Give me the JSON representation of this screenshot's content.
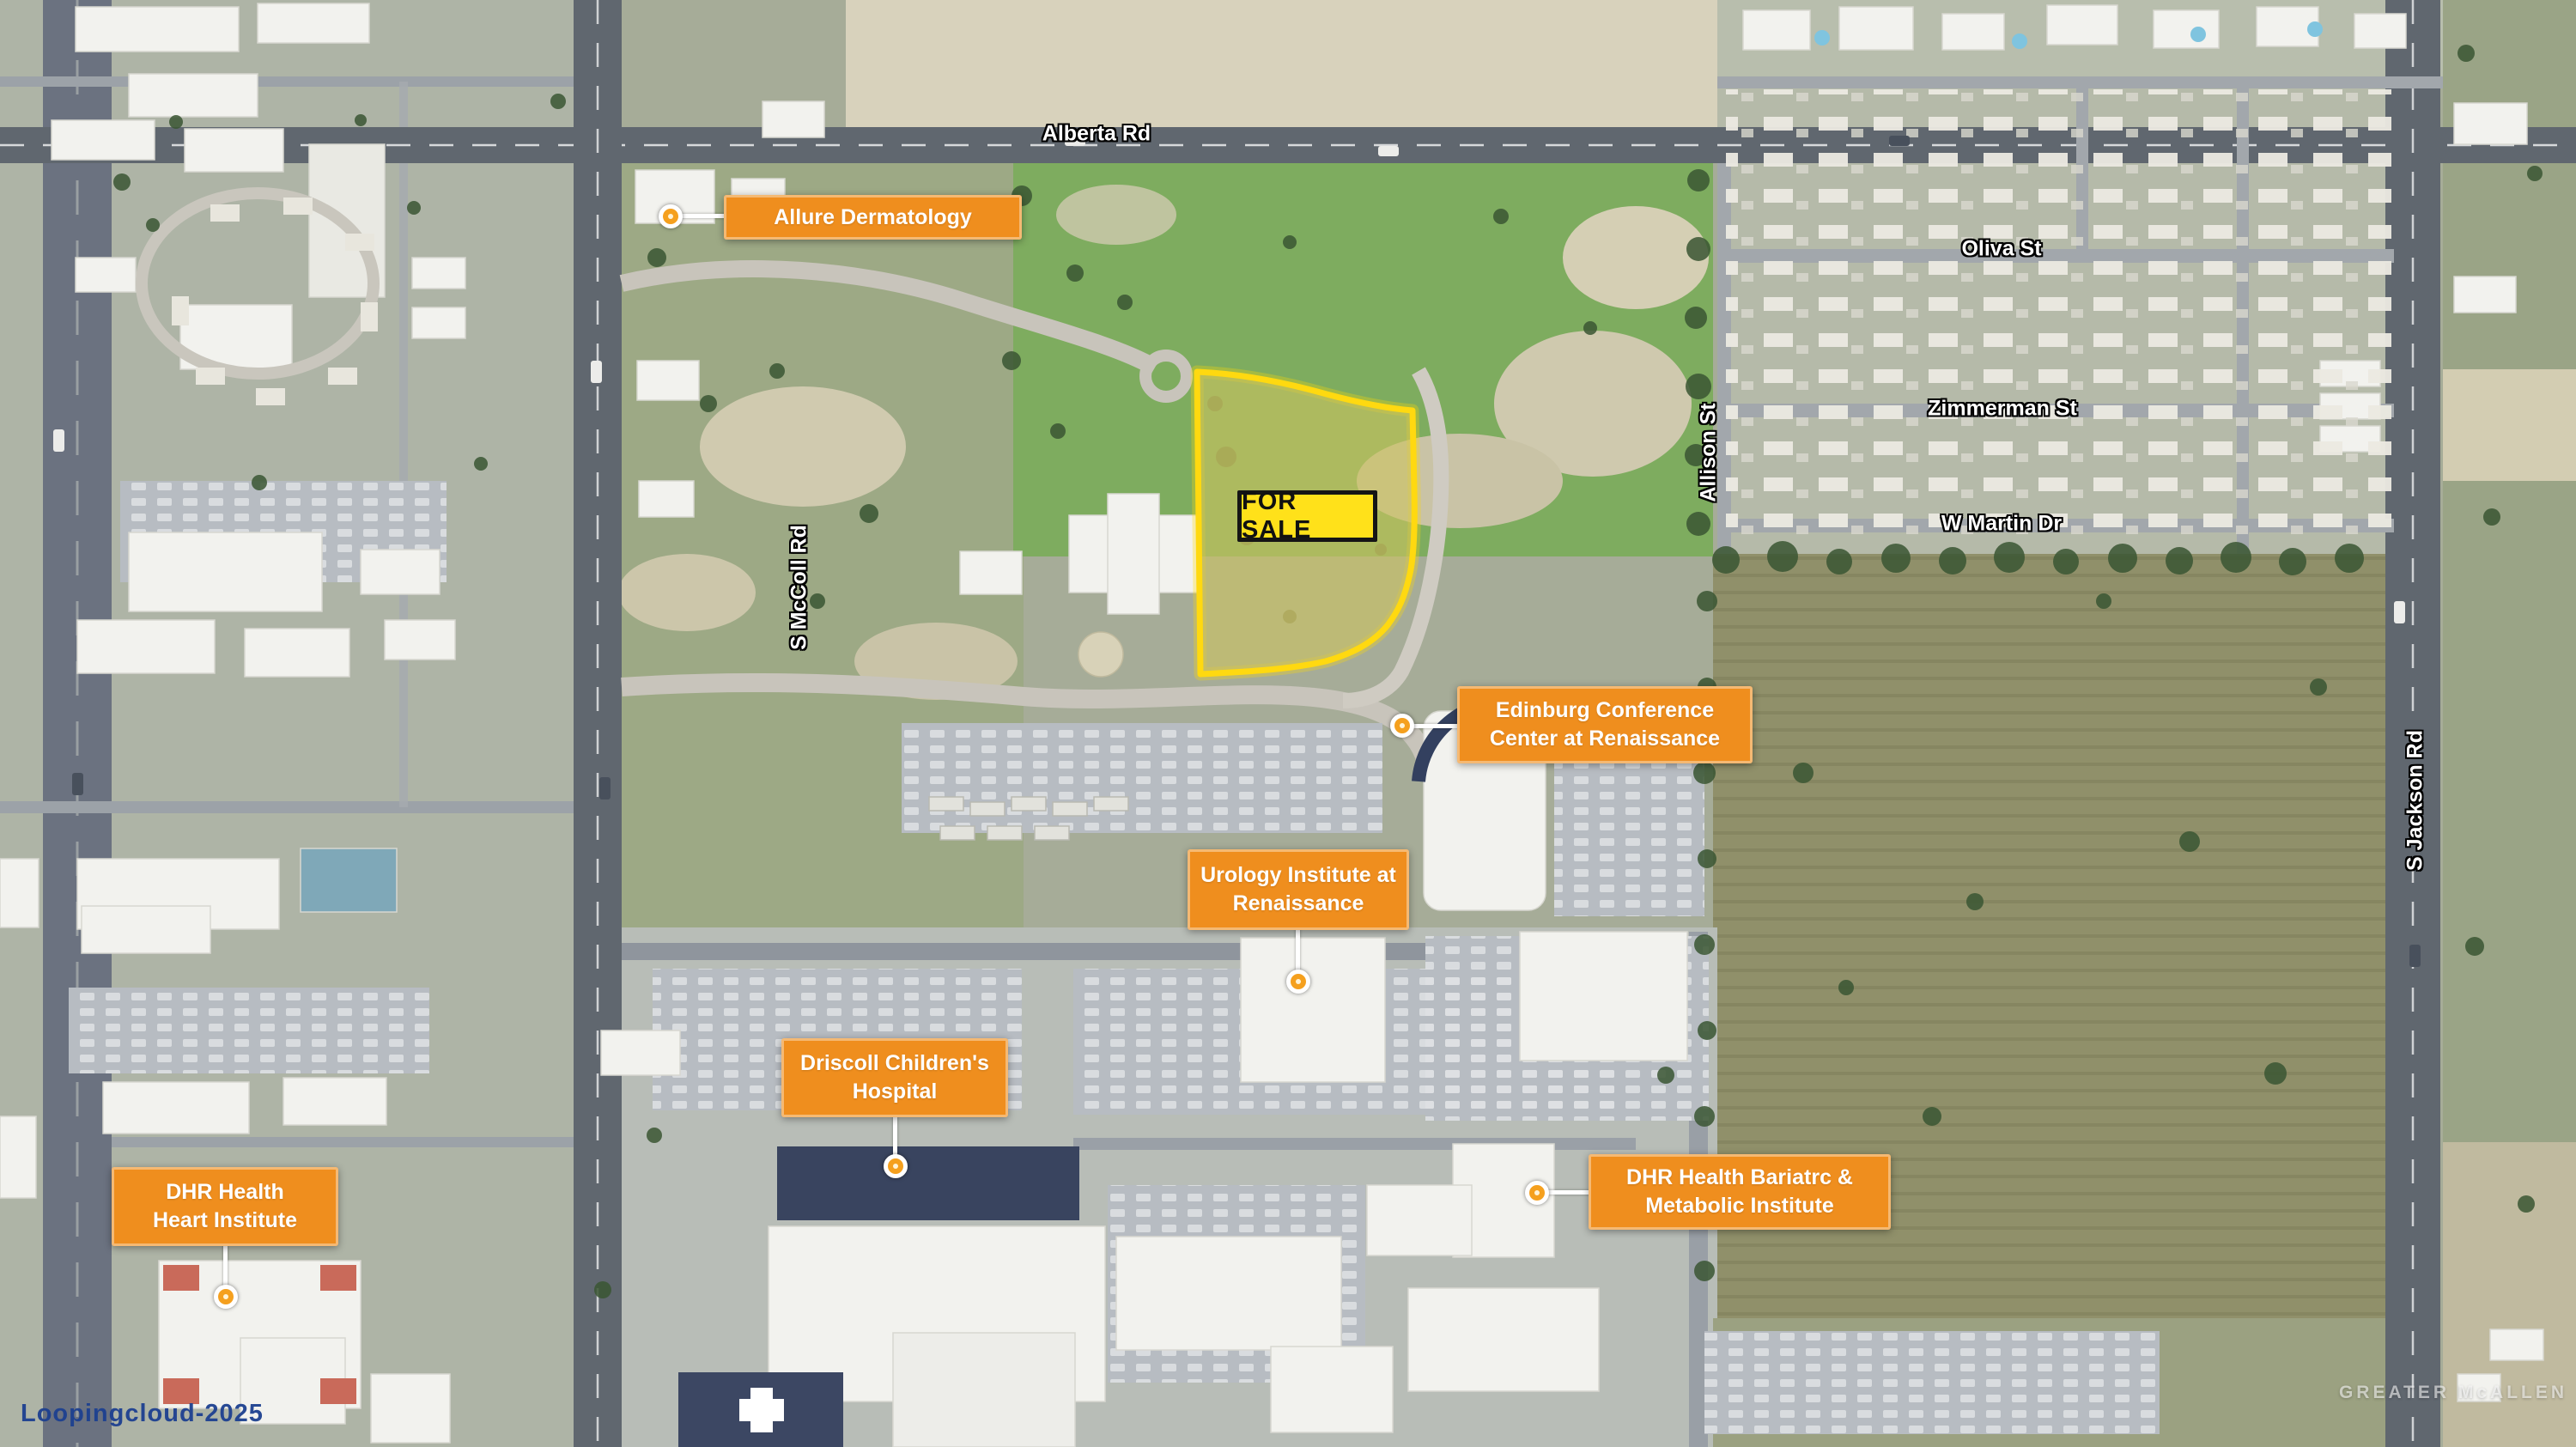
{
  "map": {
    "for_sale_badge": "FOR SALE",
    "callouts": [
      {
        "id": "allure-dermatology",
        "lines": [
          "Allure Dermatology"
        ]
      },
      {
        "id": "edinburg-conference-center",
        "lines": [
          "Edinburg Conference",
          "Center at Renaissance"
        ]
      },
      {
        "id": "urology-institute",
        "lines": [
          "Urology Institute at",
          "Renaissance"
        ]
      },
      {
        "id": "driscoll-childrens-hospital",
        "lines": [
          "Driscoll Children's",
          "Hospital"
        ]
      },
      {
        "id": "dhr-health-heart-institute",
        "lines": [
          "DHR Health",
          "Heart Institute"
        ]
      },
      {
        "id": "dhr-health-bariatric-metabolic",
        "lines": [
          "DHR Health Bariatrc &",
          "Metabolic Institute"
        ]
      }
    ],
    "street_labels": {
      "alberta": "Alberta Rd",
      "oliva": "Oliva St",
      "zimmerman": "Zimmerman St",
      "w_martin": "W Martin Dr",
      "allison": "Allison St",
      "s_mccoll": "S McColl Rd",
      "s_jackson": "S Jackson Rd"
    },
    "watermarks": {
      "bottom_left": "Loopingcloud-2025",
      "bottom_right": "GREATER McALLEN"
    },
    "colors": {
      "callout_background": "#EF8E1E",
      "callout_text": "#FFFFFF",
      "for_sale_background": "#FFE11A",
      "for_sale_text": "#111111",
      "parcel_outline": "#FFD910",
      "watermark_blue": "#1D4090"
    }
  }
}
